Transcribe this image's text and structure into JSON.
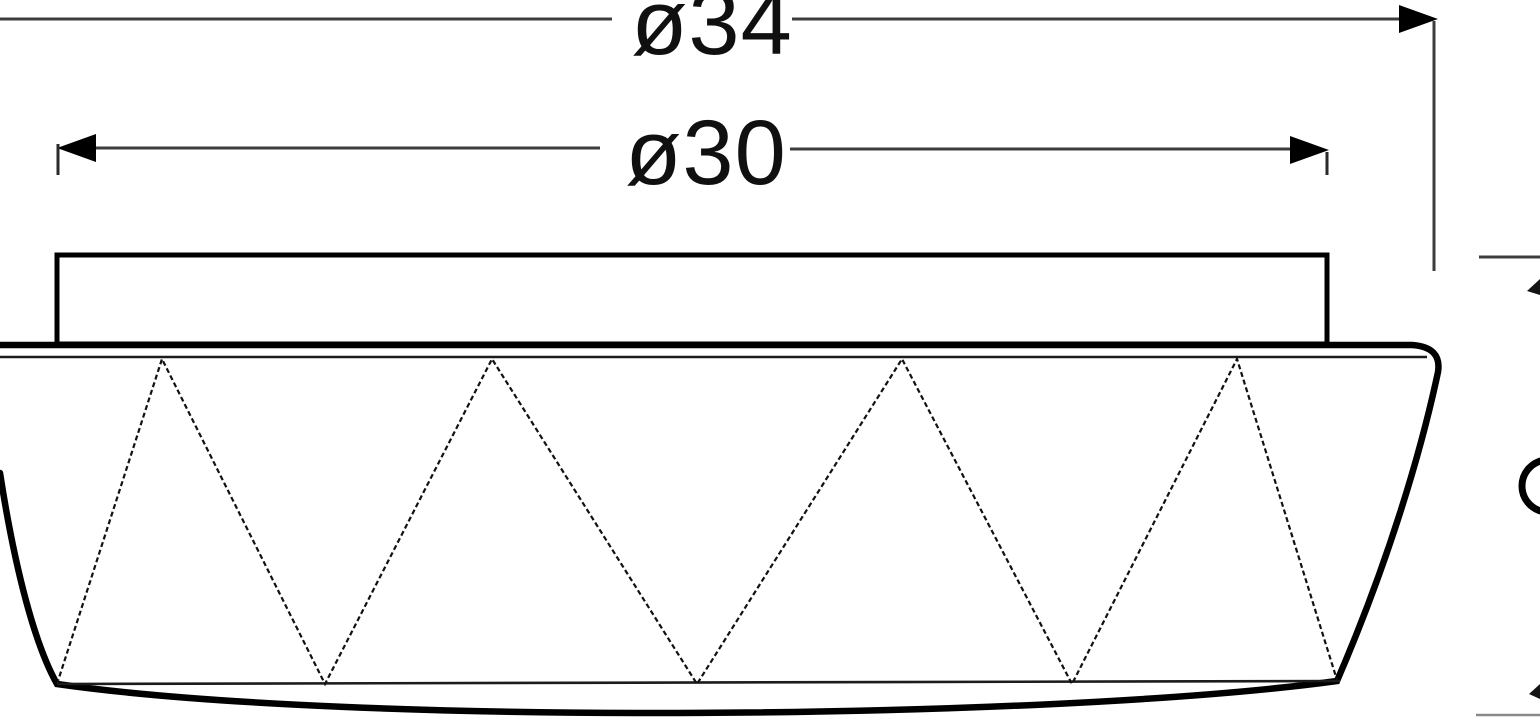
{
  "drawing": {
    "kind": "ceiling-lamp side-view dimension drawing",
    "background_color": "#ffffff",
    "outline_color": "#000000",
    "dim_line_color": "#3d3d3d",
    "dimensions": {
      "outer": {
        "label": "ø34",
        "value": 34
      },
      "plate": {
        "label": "ø30",
        "value": 30
      }
    },
    "clipped_right_annotation": {
      "glyph": "ø",
      "note": "partially visible dimension at right image edge"
    }
  }
}
